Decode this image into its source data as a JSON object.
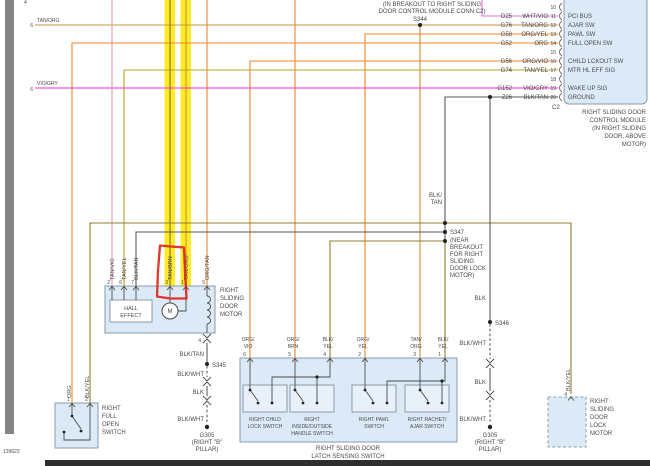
{
  "colors": {
    "tan": "#C9913D",
    "orange": "#F08428",
    "magenta": "#FF2BD6",
    "violet": "#E075DE",
    "olive": "#B5A32B",
    "dkolive": "#8F7F2F",
    "graywire": "#5a5a5a",
    "blk": "#3a3a3a",
    "pink": "#E59BA4",
    "brown": "#8A6A3A",
    "highlight": "#FFE900",
    "red": "#E0251C",
    "boxfill": "#DCEAF8",
    "boxborder": "#8A9BA8",
    "subboxfill": "#E8F1FA",
    "leftbar": "#848484",
    "bottombar": "#2E2E2E"
  },
  "doc_number": "139623",
  "top_cut_pin": "4",
  "breakout_note": {
    "l1": "(IN BREAKOUT TO RIGHT SLIDING",
    "l2": "DOOR CONTROL MODULE CONN C2)",
    "splice": "S344"
  },
  "left_edge": {
    "e1_pin": "6",
    "e1_color": "TAN/ORG",
    "e2_pin": "6",
    "e2_color": "VIO/GRY"
  },
  "connector_c2": {
    "designator": "C2",
    "rows": [
      {
        "pin": "10",
        "id": "",
        "color": "",
        "label": ""
      },
      {
        "pin": "11",
        "id": "D25",
        "color": "WHT/VIO",
        "label": "PCI BUS"
      },
      {
        "pin": "12",
        "id": "G76",
        "color": "TAN/ORG",
        "label": "AJAR SW"
      },
      {
        "pin": "13",
        "id": "G58",
        "color": "ORG/YEL",
        "label": "PAWL SW"
      },
      {
        "pin": "14",
        "id": "G52",
        "color": "ORG",
        "label": "FULL OPEN SW"
      },
      {
        "pin": "15",
        "id": "",
        "color": "",
        "label": ""
      },
      {
        "pin": "16",
        "id": "G56",
        "color": "ORG/VIO",
        "label": "CHILD LCKOUT SW"
      },
      {
        "pin": "17",
        "id": "G74",
        "color": "TAN/YEL",
        "label": "MTR HL EFF SIG"
      },
      {
        "pin": "18",
        "id": "",
        "color": "",
        "label": ""
      },
      {
        "pin": "19",
        "id": "G152",
        "color": "VIO/GRY",
        "label": "WAKE UP SIG"
      },
      {
        "pin": "20",
        "id": "Z26",
        "color": "BLK/TAN",
        "label": "GROUND"
      }
    ],
    "module": {
      "l1": "RIGHT SLIDING DOOR",
      "l2": "CONTROL MODULE",
      "l3": "(IN RIGHT SLIDING",
      "l4": "DOOR, ABOVE",
      "l5": "MOTOR)"
    }
  },
  "splices": {
    "s344": "S344",
    "s345": "S345",
    "s346": "S346",
    "s347": "S347",
    "s347_note": {
      "l1": "(NEAR",
      "l2": "BREAKOUT",
      "l3": "FOR RIGHT",
      "l4": "SLIDING",
      "l5": "DOOR LOCK",
      "l6": "MOTOR)"
    },
    "blk_tan_2l": {
      "l1": "BLK/",
      "l2": "TAN"
    },
    "blk_above_s346": "BLK"
  },
  "chain_left": {
    "pin": "4",
    "seg0": "BLK/TAN",
    "splice": "S345",
    "seg1": "BLK/WHT",
    "seg2": "BLK",
    "seg3": "BLK/WHT",
    "ground": {
      "l1": "G305",
      "l2": "(RIGHT \"B\"",
      "l3": "PILLAR)"
    }
  },
  "chain_right": {
    "seg1": "BLK/WHT",
    "seg2": "BLK",
    "seg3": "BLK/WHT",
    "ground": {
      "l1": "G305",
      "l2": "(RIGHT \"B\"",
      "l3": "PILLAR)"
    }
  },
  "motor": {
    "pins": [
      {
        "n": "2",
        "c": "TAN/VIO"
      },
      {
        "n": "6",
        "c": "TAN/YEL"
      },
      {
        "n": "7",
        "c": "BLK/TAN"
      },
      {
        "n": "3",
        "c": "TAN/BRN"
      },
      {
        "n": "1",
        "c": "TAN/ORG"
      },
      {
        "n": "5",
        "c": "ORG/TAN"
      }
    ],
    "hall": {
      "l1": "HALL",
      "l2": "EFFECT"
    },
    "m": "M",
    "label": {
      "l1": "RIGHT",
      "l2": "SLIDING",
      "l3": "DOOR",
      "l4": "MOTOR"
    }
  },
  "full_open_switch": {
    "pin1": "1",
    "pin1_color": "ORG",
    "pin2": "2",
    "pin2_color": "BLK/YEL",
    "label": {
      "l1": "RIGHT",
      "l2": "FULL",
      "l3": "OPEN",
      "l4": "SWITCH"
    }
  },
  "latch_block": {
    "label": {
      "l1": "RIGHT SLIDING DOOR",
      "l2": "LATCH SENSING SWITCH"
    },
    "pins": [
      {
        "n": "6",
        "c1": "ORG/",
        "c2": "VIO"
      },
      {
        "n": "5",
        "c1": "ORG/",
        "c2": "BRN"
      },
      {
        "n": "4",
        "c1": "BLK/",
        "c2": "YEL"
      },
      {
        "n": "2",
        "c1": "ORG/",
        "c2": "YEL"
      },
      {
        "n": "3",
        "c1": "TAN/",
        "c2": "ORG"
      },
      {
        "n": "1",
        "c1": "BLK/",
        "c2": "YEL"
      }
    ],
    "switches": [
      {
        "l1": "RIGHT CHILD",
        "l2": "LOCK SWITCH",
        "l3": ""
      },
      {
        "l1": "RIGHT",
        "l2": "INSIDE/OUTSIDE",
        "l3": "HANDLE SWITCH"
      },
      {
        "l1": "RIGHT PAWL",
        "l2": "SWITCH",
        "l3": ""
      },
      {
        "l1": "RIGHT RACHET/",
        "l2": "AJAR SWITCH",
        "l3": ""
      }
    ]
  },
  "lock_motor": {
    "pin": "4",
    "color": "BLK/YEL",
    "label": {
      "l1": "RIGHT",
      "l2": "SLIDING",
      "l3": "DOOR",
      "l4": "LOCK",
      "l5": "MOTOR"
    }
  }
}
